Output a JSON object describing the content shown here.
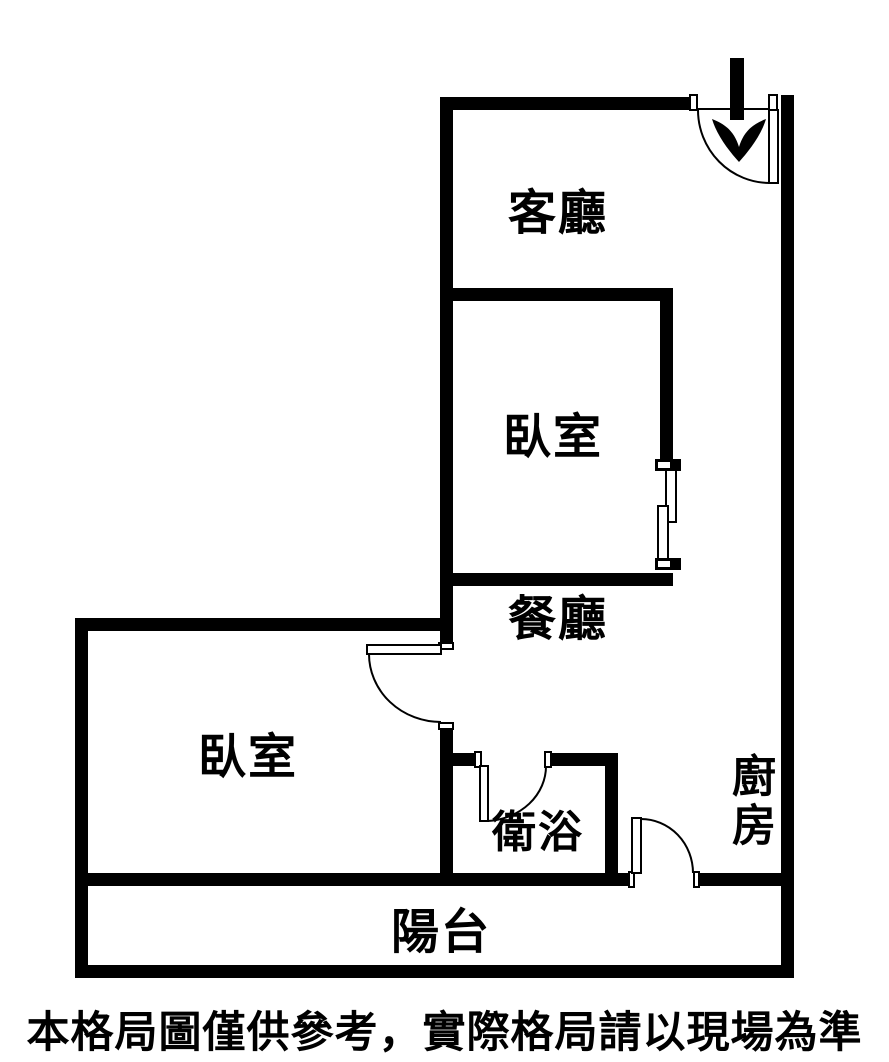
{
  "floor_plan": {
    "rooms": [
      {
        "id": "living-room",
        "label": "客廳"
      },
      {
        "id": "bedroom-upper",
        "label": "臥室"
      },
      {
        "id": "dining-room",
        "label": "餐廳"
      },
      {
        "id": "bedroom-left",
        "label": "臥室"
      },
      {
        "id": "bathroom",
        "label": "衛浴"
      },
      {
        "id": "kitchen",
        "label": "廚房"
      },
      {
        "id": "balcony",
        "label": "陽台"
      }
    ],
    "icons": [
      {
        "name": "entrance-arrow-icon",
        "meaning": "entrance direction into living room"
      }
    ],
    "features": [
      "entrance-swing-door-top-right",
      "swing-door-bedroom-left",
      "swing-door-bathroom",
      "swing-door-kitchen-to-balcony",
      "sliding-window-bedroom-upper-right-wall"
    ],
    "colors": {
      "wall": "#000000",
      "background": "#ffffff",
      "text": "#000000"
    }
  },
  "disclaimer": "本格局圖僅供參考，實際格局請以現場為準"
}
